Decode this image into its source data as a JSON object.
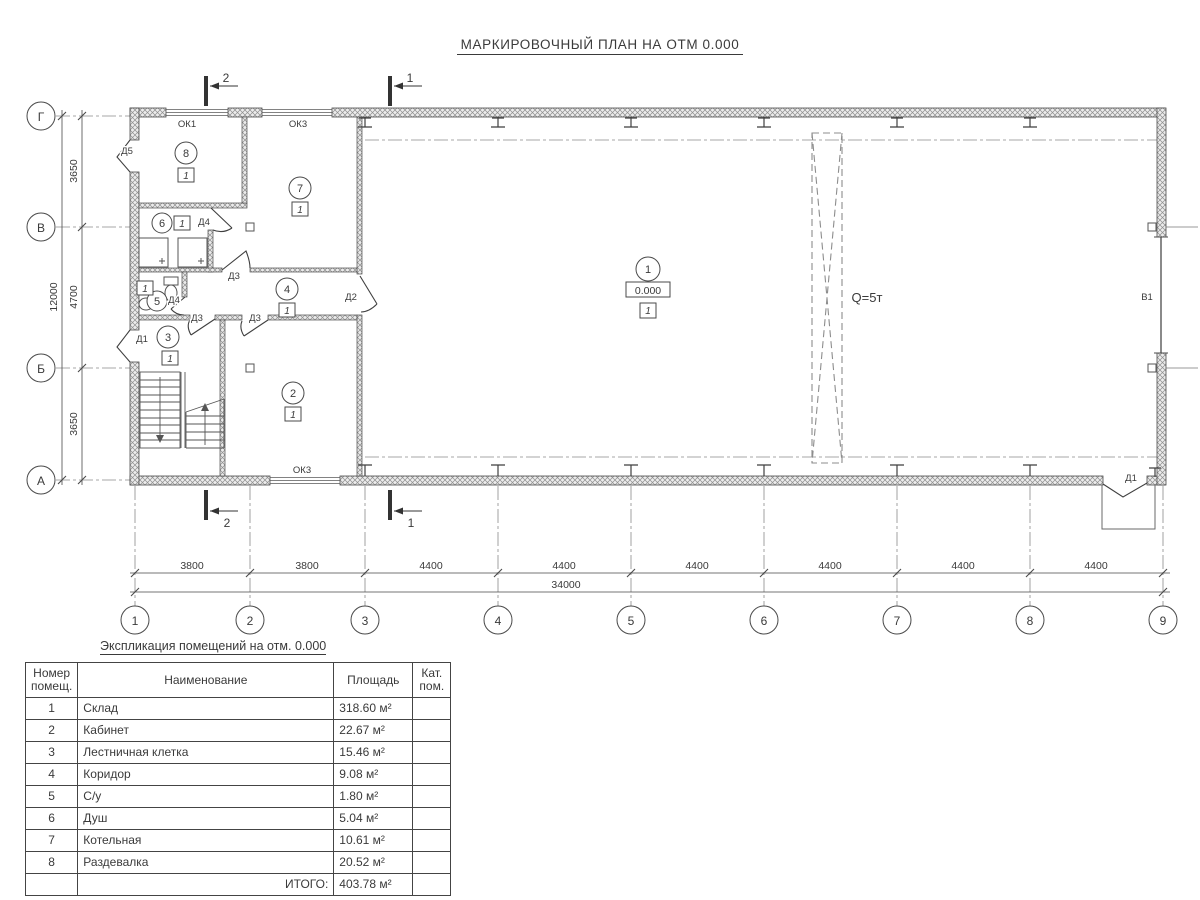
{
  "title": "МАРКИРОВОЧНЫЙ ПЛАН НА ОТМ 0.000",
  "axes": {
    "horizontal": [
      "1",
      "2",
      "3",
      "4",
      "5",
      "6",
      "7",
      "8",
      "9"
    ],
    "vertical": [
      "Г",
      "В",
      "Б",
      "А"
    ]
  },
  "dimensions": {
    "bottom_spans": [
      "3800",
      "3800",
      "4400",
      "4400",
      "4400",
      "4400",
      "4400",
      "4400"
    ],
    "bottom_total": "34000",
    "left_spans": [
      "3650",
      "4700",
      "3650"
    ],
    "left_total": "12000"
  },
  "sections": {
    "s1": "1",
    "s2": "2"
  },
  "rooms": {
    "r1": {
      "number": "1",
      "floor": "1",
      "level": "0.000"
    },
    "r2": {
      "number": "2",
      "floor": "1"
    },
    "r3": {
      "number": "3",
      "floor": "1"
    },
    "r4": {
      "number": "4",
      "floor": "1"
    },
    "r5": {
      "number": "5",
      "floor": "1"
    },
    "r6": {
      "number": "6",
      "floor": "1"
    },
    "r7": {
      "number": "7",
      "floor": "1"
    },
    "r8": {
      "number": "8",
      "floor": "1"
    }
  },
  "labels": {
    "crane": "Q=5т",
    "gate": "В1",
    "doors": {
      "d1": "Д1",
      "d2": "Д2",
      "d3": "Д3",
      "d4": "Д4",
      "d5": "Д5"
    },
    "windows": {
      "ok1": "ОК1",
      "ok3": "ОК3"
    }
  },
  "table": {
    "caption": "Экспликация помещений на отм. 0.000",
    "headers": {
      "number": "Номер помещ.",
      "name": "Наименование",
      "area": "Площадь",
      "category": "Кат. пом."
    },
    "rows": [
      {
        "num": "1",
        "name": "Склад",
        "area": "318.60 м²",
        "cat": ""
      },
      {
        "num": "2",
        "name": "Кабинет",
        "area": "22.67 м²",
        "cat": ""
      },
      {
        "num": "3",
        "name": "Лестничная клетка",
        "area": "15.46 м²",
        "cat": ""
      },
      {
        "num": "4",
        "name": "Коридор",
        "area": "9.08 м²",
        "cat": ""
      },
      {
        "num": "5",
        "name": "С/у",
        "area": "1.80 м²",
        "cat": ""
      },
      {
        "num": "6",
        "name": "Душ",
        "area": "5.04 м²",
        "cat": ""
      },
      {
        "num": "7",
        "name": "Котельная",
        "area": "10.61 м²",
        "cat": ""
      },
      {
        "num": "8",
        "name": "Раздевалка",
        "area": "20.52 м²",
        "cat": ""
      }
    ],
    "total_label": "ИТОГО:",
    "total_area": "403.78 м²"
  }
}
